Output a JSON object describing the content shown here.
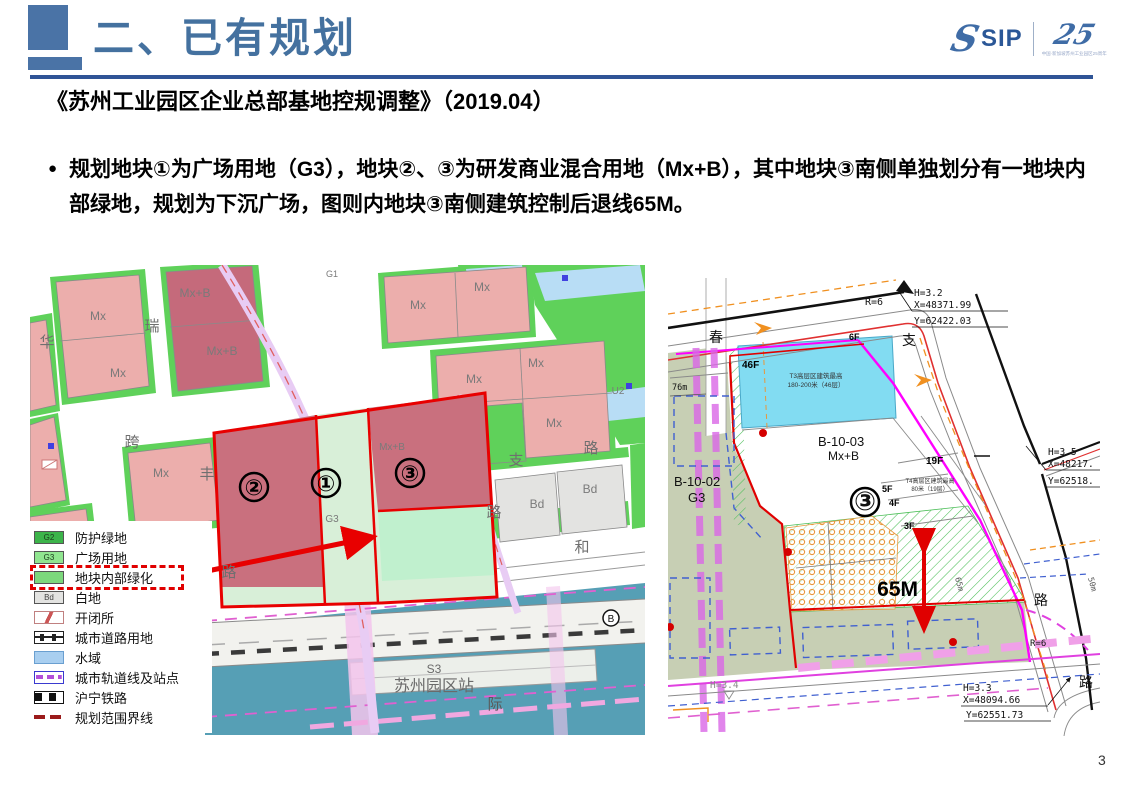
{
  "page_number": "3",
  "header": {
    "title": "二、已有规划",
    "logo": {
      "sip": "SIP",
      "anniversary": "25",
      "tagline": "中国·新加坡苏州工业园区25周年"
    }
  },
  "subtitle": "《苏州工业园区企业总部基地控规调整》（2019.04）",
  "bullet_marker": "●",
  "bullet_text": "规划地块①为广场用地（G3），地块②、③为研发商业混合用地（Mx+B），其中地块③南侧单独划分有一地块内部绿地，规划为下沉广场，图则内地块③南侧建筑控制后退线65M。",
  "left_map": {
    "blocks": {
      "mx1": "Mx",
      "mx2": "Mx",
      "mx3": "Mx",
      "mx4": "Mx",
      "mx5": "Mx",
      "mx6": "Mx",
      "mx7": "Mx",
      "mx8": "Mx",
      "mx9": "Mx",
      "mxb1": "Mx+B",
      "mxb2": "Mx+B",
      "mxb_inner": "Mx+B",
      "bd1": "Bd",
      "bd2": "Bd",
      "g1": "G1",
      "u2": "U2",
      "g3_inner": "G3",
      "c1": "①",
      "c2": "②",
      "c3": "③",
      "b": "B"
    },
    "roads": {
      "hua": "华",
      "rui": "瑞",
      "kua": "跨",
      "feng": "丰",
      "lu1": "路",
      "lu2": "路",
      "lu3": "路",
      "zhi": "支",
      "he": "和",
      "ji": "际"
    },
    "station": {
      "code": "S3",
      "name": "苏州园区站"
    },
    "legend": {
      "items": [
        {
          "code": "G2",
          "label": "防护绿地"
        },
        {
          "code": "G3",
          "label": "广场用地"
        },
        {
          "code": "",
          "label": "地块内部绿化"
        },
        {
          "code": "Bd",
          "label": "白地"
        },
        {
          "code": "",
          "label": "开闭所"
        },
        {
          "code": "",
          "label": "城市道路用地"
        },
        {
          "code": "",
          "label": "水域"
        },
        {
          "code": "",
          "label": "城市轨道线及站点"
        },
        {
          "code": "",
          "label": "沪宁铁路"
        },
        {
          "code": "",
          "label": "规划范围界线"
        }
      ]
    }
  },
  "right_map": {
    "parcels": {
      "b1002": "B-10-02",
      "b1002_use": "G3",
      "b1003": "B-10-03",
      "b1003_use": "Mx+B",
      "circle3": "③"
    },
    "buildings": {
      "t3a": "T3高层区建筑最高",
      "t3b": "180-200米（46层）",
      "t4a": "T4高层区建筑最高",
      "t4b": "80米（19层）"
    },
    "floors": {
      "f46": "46F",
      "f19": "19F",
      "f6": "6F",
      "f5": "5F",
      "f4": "4F",
      "f3": "3F"
    },
    "dims": {
      "d65M": "65M",
      "d65m": "65m",
      "d76m": "76m",
      "d50m": "50m",
      "r6a": "R=6",
      "r6b": "R=6"
    },
    "coords": {
      "c1h": "H=3.2",
      "c1x": "X=48371.99",
      "c1y": "Y=62422.03",
      "c2h": "H=3.5",
      "c2x": "X=48217.",
      "c2y": "Y=62518.",
      "c3h": "H=3.3",
      "c3x": "X=48094.66",
      "c3y": "Y=62551.73",
      "c4h": "H=3.4"
    },
    "roads": {
      "chun": "春",
      "zhi": "支",
      "lu1": "路",
      "lu2": "路"
    }
  }
}
